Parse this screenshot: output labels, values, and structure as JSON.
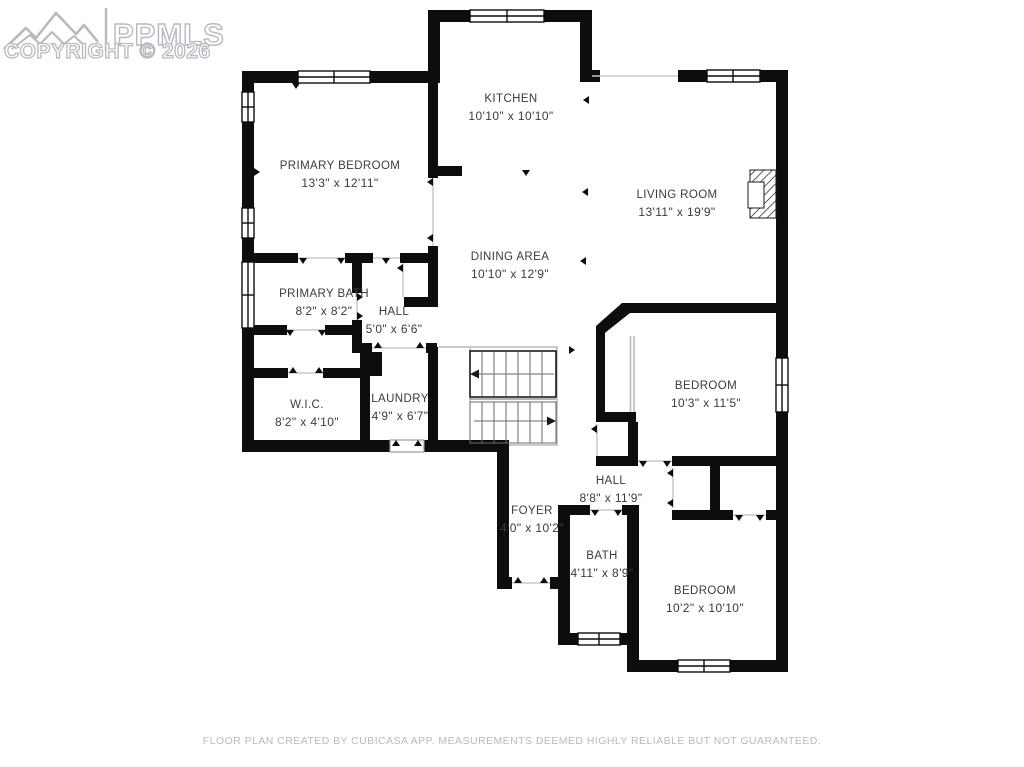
{
  "logo": {
    "brand": "PPMLS",
    "copyright": "COPYRIGHT © 2026"
  },
  "rooms": [
    {
      "name": "KITCHEN",
      "dims": "10'10\" x 10'10\"",
      "x": 511,
      "y": 108
    },
    {
      "name": "PRIMARY BEDROOM",
      "dims": "13'3\" x 12'11\"",
      "x": 340,
      "y": 175
    },
    {
      "name": "LIVING ROOM",
      "dims": "13'11\" x 19'9\"",
      "x": 677,
      "y": 204
    },
    {
      "name": "DINING AREA",
      "dims": "10'10\" x 12'9\"",
      "x": 510,
      "y": 266
    },
    {
      "name": "PRIMARY BATH",
      "dims": "8'2\" x 8'2\"",
      "x": 324,
      "y": 303
    },
    {
      "name": "HALL",
      "dims": "5'0\" x 6'6\"",
      "x": 394,
      "y": 321
    },
    {
      "name": "W.I.C.",
      "dims": "8'2\" x 4'10\"",
      "x": 307,
      "y": 414
    },
    {
      "name": "LAUNDRY",
      "dims": "4'9\" x 6'7\"",
      "x": 400,
      "y": 408
    },
    {
      "name": "BEDROOM",
      "dims": "10'3\" x 11'5\"",
      "x": 706,
      "y": 395
    },
    {
      "name": "HALL",
      "dims": "8'8\" x 11'9\"",
      "x": 611,
      "y": 490
    },
    {
      "name": "FOYER",
      "dims": "4'0\" x 10'2\"",
      "x": 532,
      "y": 520
    },
    {
      "name": "BATH",
      "dims": "4'11\" x 8'9\"",
      "x": 602,
      "y": 565
    },
    {
      "name": "BEDROOM",
      "dims": "10'2\" x 10'10\"",
      "x": 705,
      "y": 600
    }
  ],
  "footer": {
    "disclaimer": "FLOOR PLAN CREATED BY CUBICASA APP. MEASUREMENTS DEEMED HIGHLY RELIABLE BUT NOT GUARANTEED."
  },
  "colors": {
    "wall": "#0d0d0d",
    "label": "#3b3b3b",
    "logo": "#b5bac0",
    "muted": "#b7babc",
    "bg": "#ffffff"
  }
}
